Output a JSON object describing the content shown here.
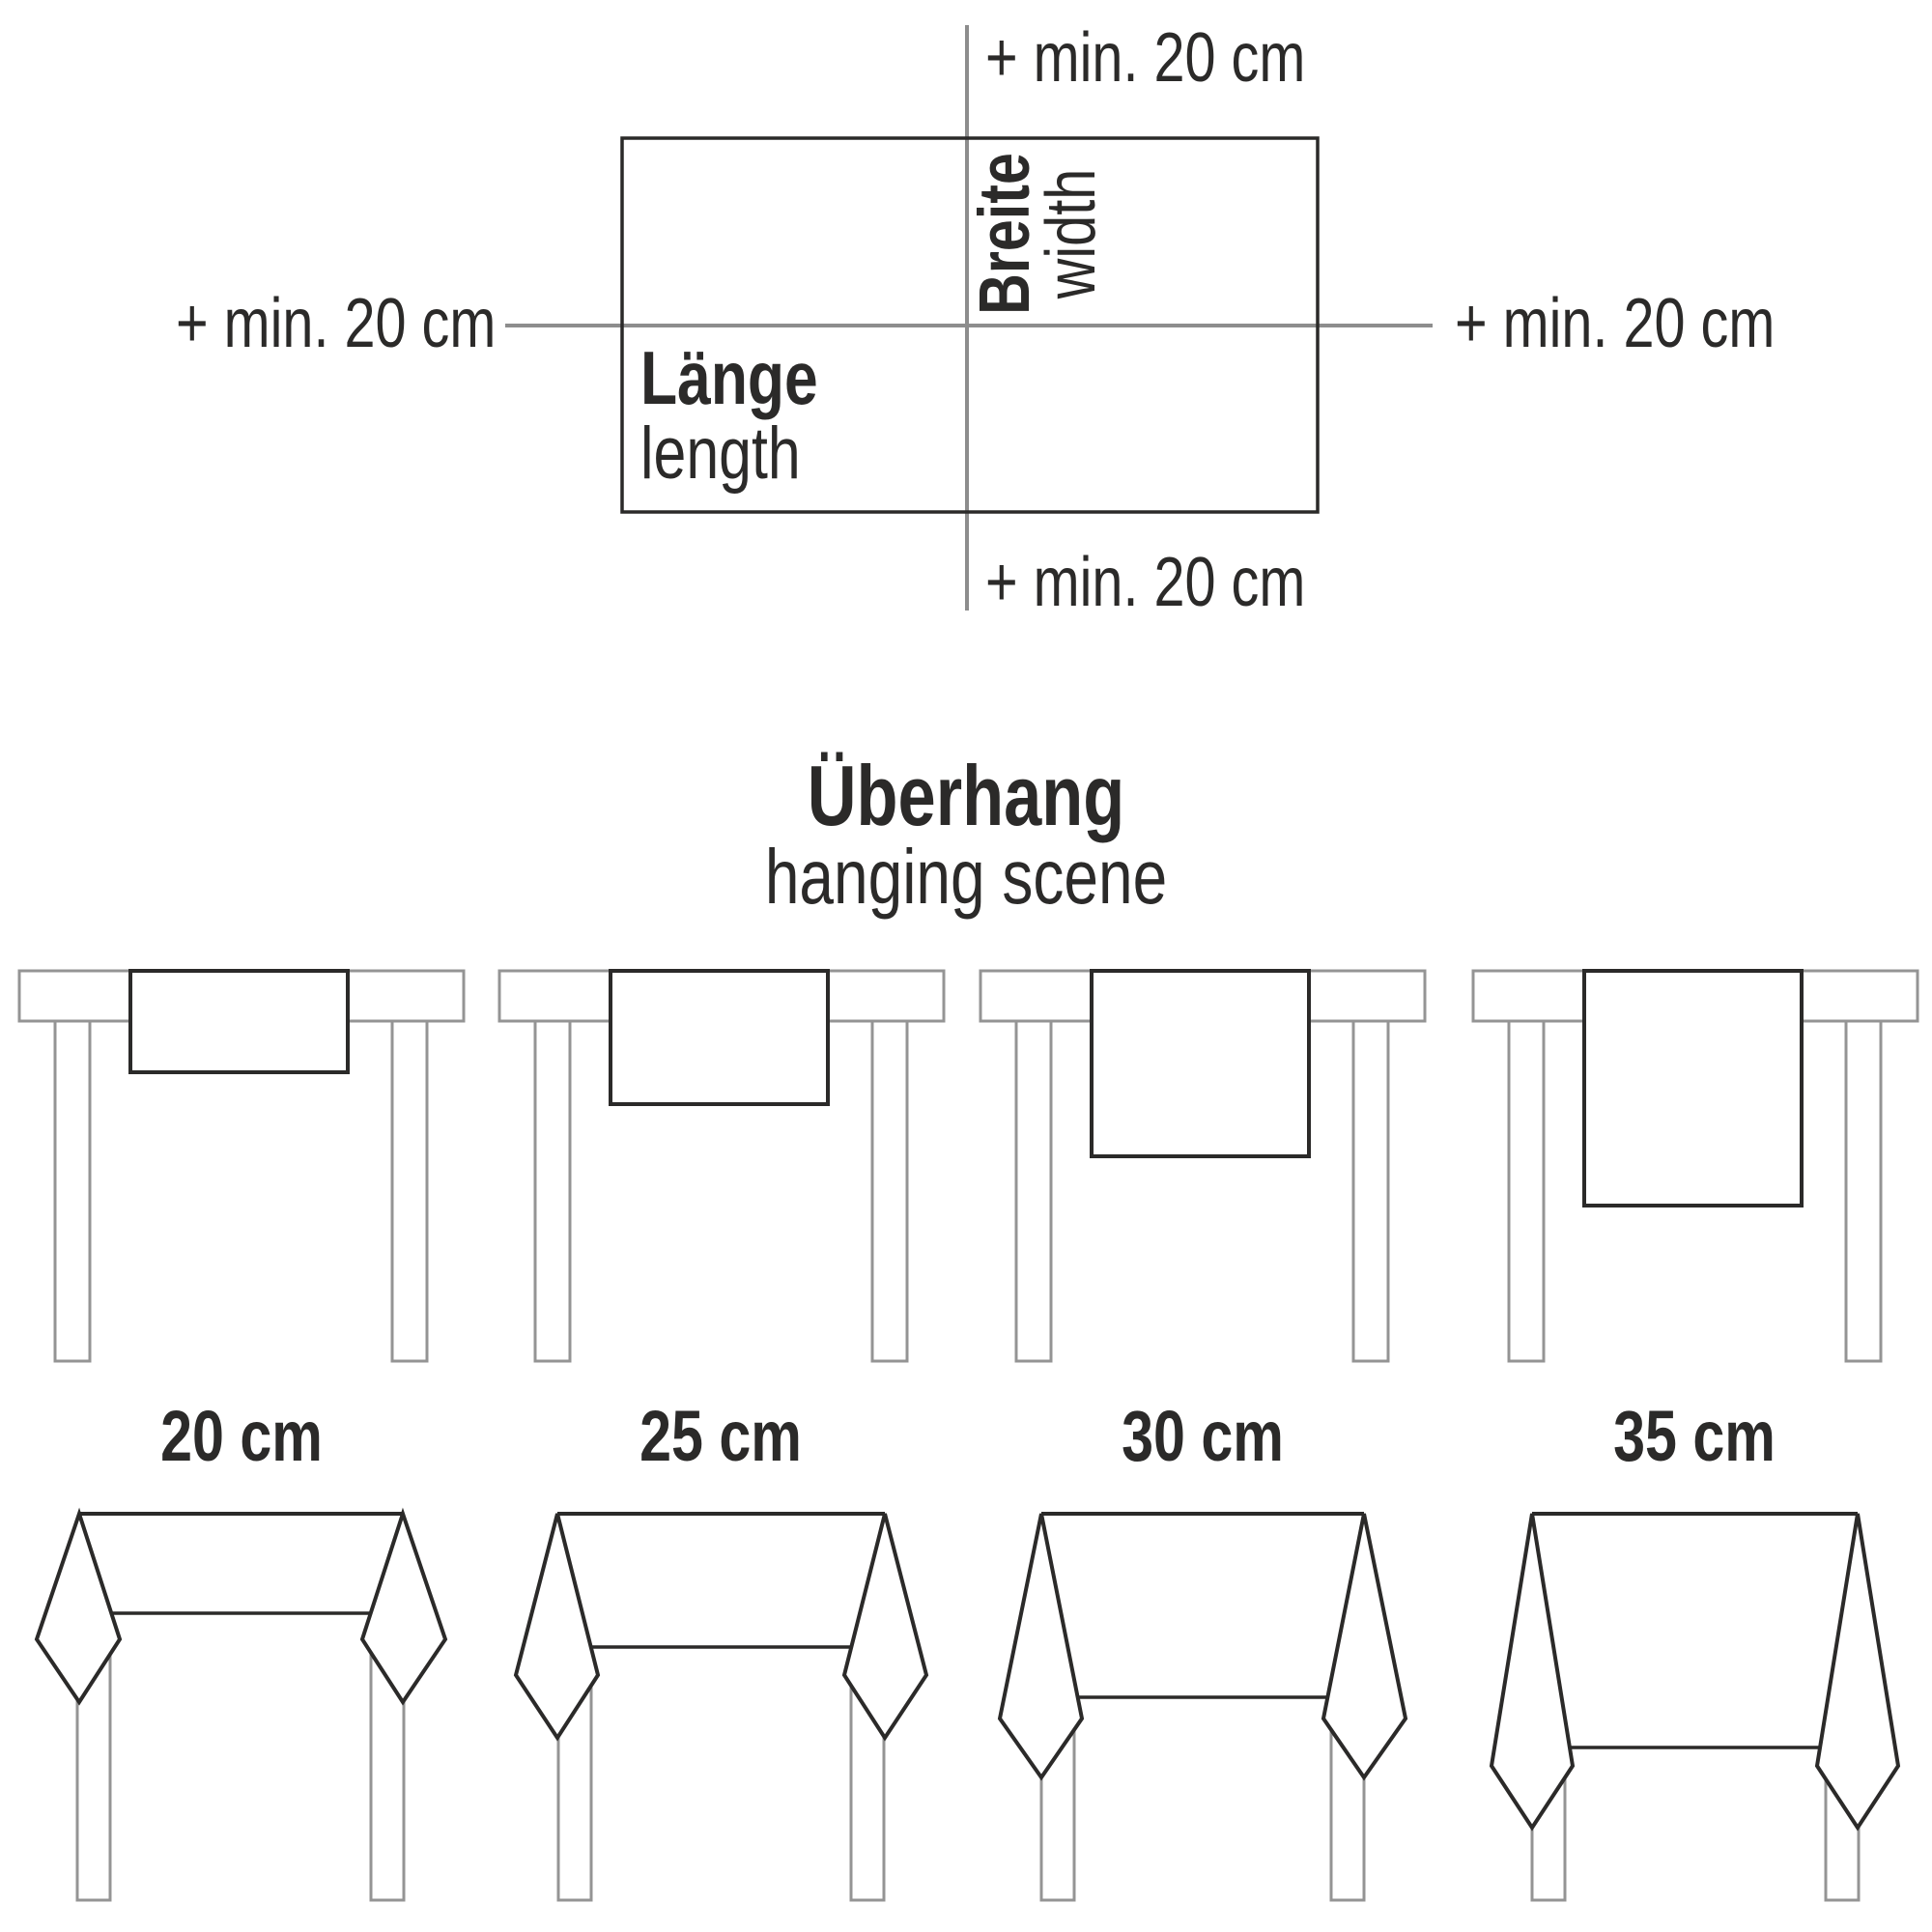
{
  "page": {
    "background": "#ffffff"
  },
  "colors": {
    "text": "#2b2a29",
    "cloth_outline": "#2b2a29",
    "axis_line": "#8d8d8d",
    "table_outline": "#949494"
  },
  "size_diagram": {
    "add_top": "+ min. 20 cm",
    "add_left": "+ min. 20 cm",
    "add_right": "+ min. 20 cm",
    "add_bottom": "+ min. 20 cm",
    "length_de": "Länge",
    "length_en": "length",
    "width_de": "Breite",
    "width_en": "width"
  },
  "overhang_section": {
    "title_de": "Überhang",
    "title_en": "hanging scene",
    "items": [
      {
        "label": "20 cm",
        "value_cm": 20
      },
      {
        "label": "25 cm",
        "value_cm": 25
      },
      {
        "label": "30 cm",
        "value_cm": 30
      },
      {
        "label": "35 cm",
        "value_cm": 35
      }
    ]
  }
}
